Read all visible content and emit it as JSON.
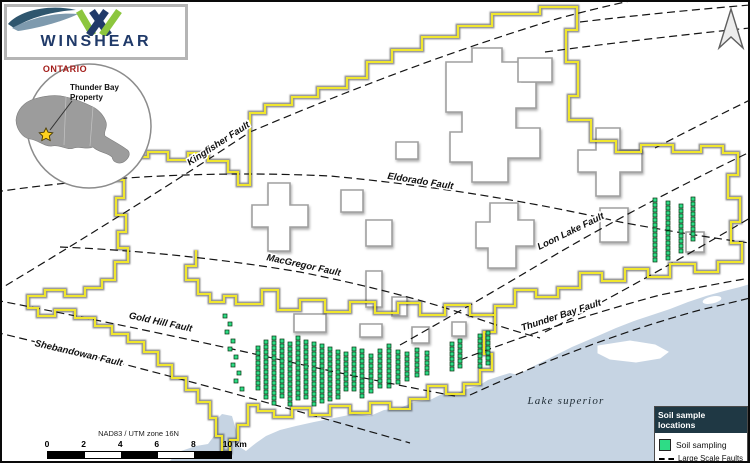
{
  "logo": {
    "text": "WINSHEAR"
  },
  "inset": {
    "title": "ONTARIO",
    "label_line1": "Thunder Bay",
    "label_line2": "Property"
  },
  "fault_labels": [
    {
      "text": "Kingfisher Fault",
      "x": 220,
      "y": 146,
      "rot": -33
    },
    {
      "text": "Eldorado Fault",
      "x": 420,
      "y": 184,
      "rot": 9
    },
    {
      "text": "Loon Lake Fault",
      "x": 572,
      "y": 234,
      "rot": -26
    },
    {
      "text": "MacGregor Fault",
      "x": 303,
      "y": 268,
      "rot": 12
    },
    {
      "text": "Gold Hill Fault",
      "x": 160,
      "y": 325,
      "rot": 12
    },
    {
      "text": "Shebandowan Fault",
      "x": 78,
      "y": 356,
      "rot": 13
    },
    {
      "text": "Thunder Bay Fault",
      "x": 562,
      "y": 318,
      "rot": -18
    }
  ],
  "lake_label": {
    "text": "Lake superior",
    "x": 566,
    "y": 404
  },
  "scalebar": {
    "crs": "NAD83 / UTM zone 16N",
    "ticks": [
      "0",
      "2",
      "4",
      "6",
      "8"
    ],
    "end_label": "10 km"
  },
  "legend": {
    "title": "Soil sample locations",
    "items": [
      {
        "label": "Soil sampling",
        "type": "green-square"
      },
      {
        "label": "Large Scale Faults",
        "type": "dashed-line"
      }
    ]
  },
  "colors": {
    "boundary_yellow": "#f0e62e",
    "sample_green": "#2edc86",
    "lake_blue": "#c6d4e3",
    "legend_header": "#1f3844",
    "ontario_red": "#a31d1a",
    "logo_navy": "#203a69",
    "logo_green": "#8cc63e"
  },
  "samples": {
    "square_size": 4,
    "spacing": 5,
    "sw_strips": [
      [
        258,
        348,
        390
      ],
      [
        266,
        342,
        398
      ],
      [
        274,
        338,
        404
      ],
      [
        282,
        341,
        400
      ],
      [
        290,
        344,
        406
      ],
      [
        298,
        338,
        402
      ],
      [
        306,
        342,
        398
      ],
      [
        314,
        344,
        407
      ],
      [
        322,
        346,
        402
      ],
      [
        330,
        349,
        399
      ],
      [
        338,
        352,
        397
      ],
      [
        346,
        354,
        392
      ],
      [
        354,
        349,
        390
      ],
      [
        362,
        351,
        396
      ],
      [
        371,
        356,
        391
      ],
      [
        380,
        351,
        386
      ],
      [
        389,
        346,
        390
      ],
      [
        398,
        352,
        382
      ],
      [
        407,
        354,
        380
      ],
      [
        417,
        350,
        378
      ],
      [
        427,
        353,
        376
      ],
      [
        452,
        344,
        372
      ],
      [
        460,
        341,
        369
      ],
      [
        480,
        336,
        366
      ],
      [
        488,
        333,
        364
      ]
    ],
    "sw_dots": [
      [
        225,
        316
      ],
      [
        230,
        324
      ],
      [
        227,
        332
      ],
      [
        233,
        341
      ],
      [
        230,
        349
      ],
      [
        236,
        357
      ],
      [
        233,
        365
      ],
      [
        239,
        373
      ],
      [
        236,
        381
      ],
      [
        242,
        389
      ]
    ],
    "east_strips": [
      [
        655,
        200,
        262
      ],
      [
        668,
        203,
        258
      ],
      [
        681,
        206,
        255
      ],
      [
        693,
        199,
        240
      ]
    ]
  }
}
